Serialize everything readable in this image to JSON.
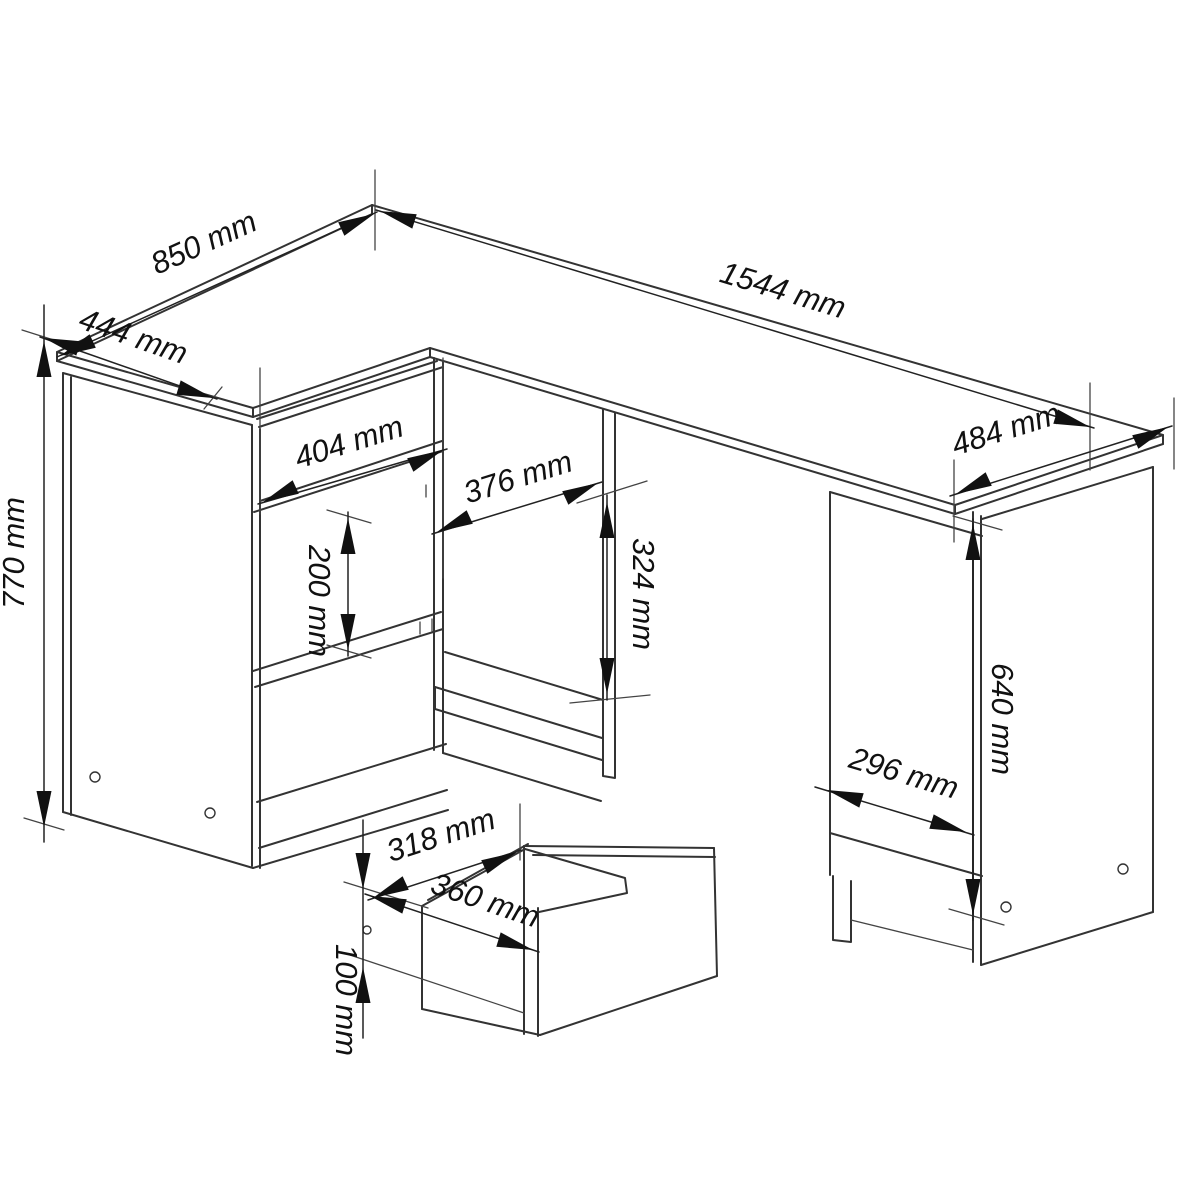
{
  "drawing": {
    "type": "furniture technical drawing",
    "subject": "corner desk with drawer cabinet, open shelf, side cabinet and detached drawer detail",
    "background_color": "#ffffff",
    "line_color": "#333333",
    "unit": "mm"
  },
  "dims": {
    "desk_depth_left": "850 mm",
    "desk_front_left_width": "444 mm",
    "desk_total_width": "1544 mm",
    "desk_depth_right": "484 mm",
    "drawer_front_width": "404 mm",
    "shelf_opening_width": "376 mm",
    "shelf_opening_height": "324 mm",
    "middle_drawer_height": "200 mm",
    "desk_total_height": "770 mm",
    "side_cabinet_height": "640 mm",
    "side_cabinet_width": "296 mm",
    "drawer_inner_width": "318 mm",
    "drawer_outer_width": "360 mm",
    "drawer_box_height": "100 mm"
  }
}
